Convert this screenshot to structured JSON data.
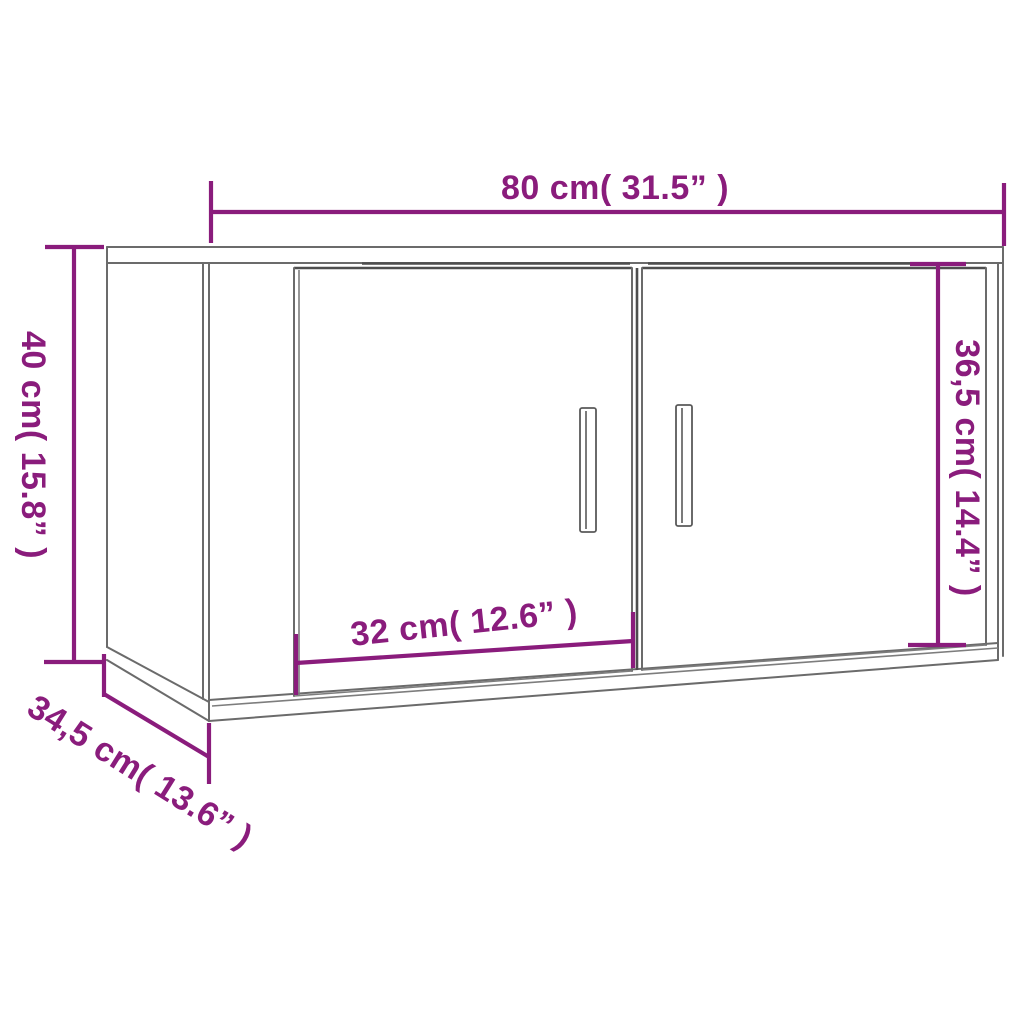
{
  "diagram": {
    "type": "product-dimension-diagram",
    "subject": "wall-mounted two-door cabinet, three-quarter line drawing",
    "background": "#ffffff",
    "palette": {
      "dimension_color": "#8a1c7c",
      "outline_color": "#6b6b6b",
      "outline_dark": "#4e4e4e",
      "surface": "#ffffff"
    },
    "dimensions": {
      "width": {
        "cm": "80",
        "inches": "31.5",
        "label": "80 cm( 31.5” )",
        "position": "top-horizontal"
      },
      "height": {
        "cm": "40",
        "inches": "15.8",
        "label": "40 cm( 15.8” )",
        "position": "left-vertical"
      },
      "door_height": {
        "cm": "36,5",
        "inches": "14.4",
        "label": "36,5 cm( 14.4” )",
        "position": "right-vertical"
      },
      "door_width": {
        "cm": "32",
        "inches": "12.6",
        "label": "32 cm( 12.6” )",
        "position": "bottom-front"
      },
      "depth": {
        "cm": "34,5",
        "inches": "13.6",
        "label": "34,5 cm( 13.6” )",
        "position": "bottom-left-diagonal"
      }
    }
  }
}
